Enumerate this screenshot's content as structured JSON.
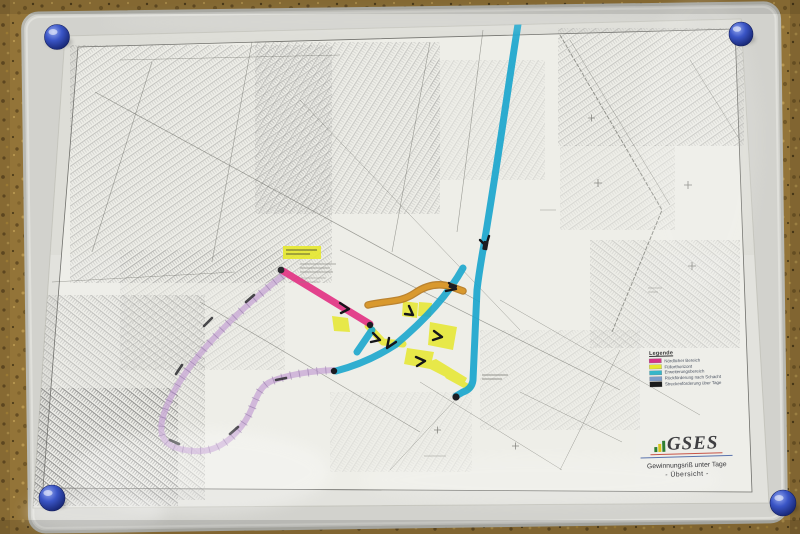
{
  "photo": {
    "surface": "cork-board",
    "pins": {
      "count": 4,
      "color": "#2e47b4"
    }
  },
  "map": {
    "legend": {
      "title": "Legende",
      "items": [
        {
          "label": "Nördlicher Bereich",
          "color": "#d43487"
        },
        {
          "label": "Füllorthorizont",
          "color": "#e6e82e"
        },
        {
          "label": "Erweiterungsbereich",
          "color": "#35b6c9"
        },
        {
          "label": "Rückförderung nach Schacht",
          "color": "#7b9cc9"
        },
        {
          "label": "Streckenförderung über Tage",
          "color": "#1a1a1a"
        }
      ]
    },
    "logo": {
      "text": "GSES"
    },
    "title_block": {
      "line1": "Gewinnungsriß unter Tage",
      "line2": "- Übersicht -"
    },
    "colors": {
      "cyan": "#1ba6cd",
      "magenta": "#e23383",
      "orange": "#d9992e",
      "orange_edge": "#b5771c",
      "purple": "#c9aad6",
      "yellow": "#e6e82e",
      "pin_blue": "#2e47b4"
    }
  }
}
